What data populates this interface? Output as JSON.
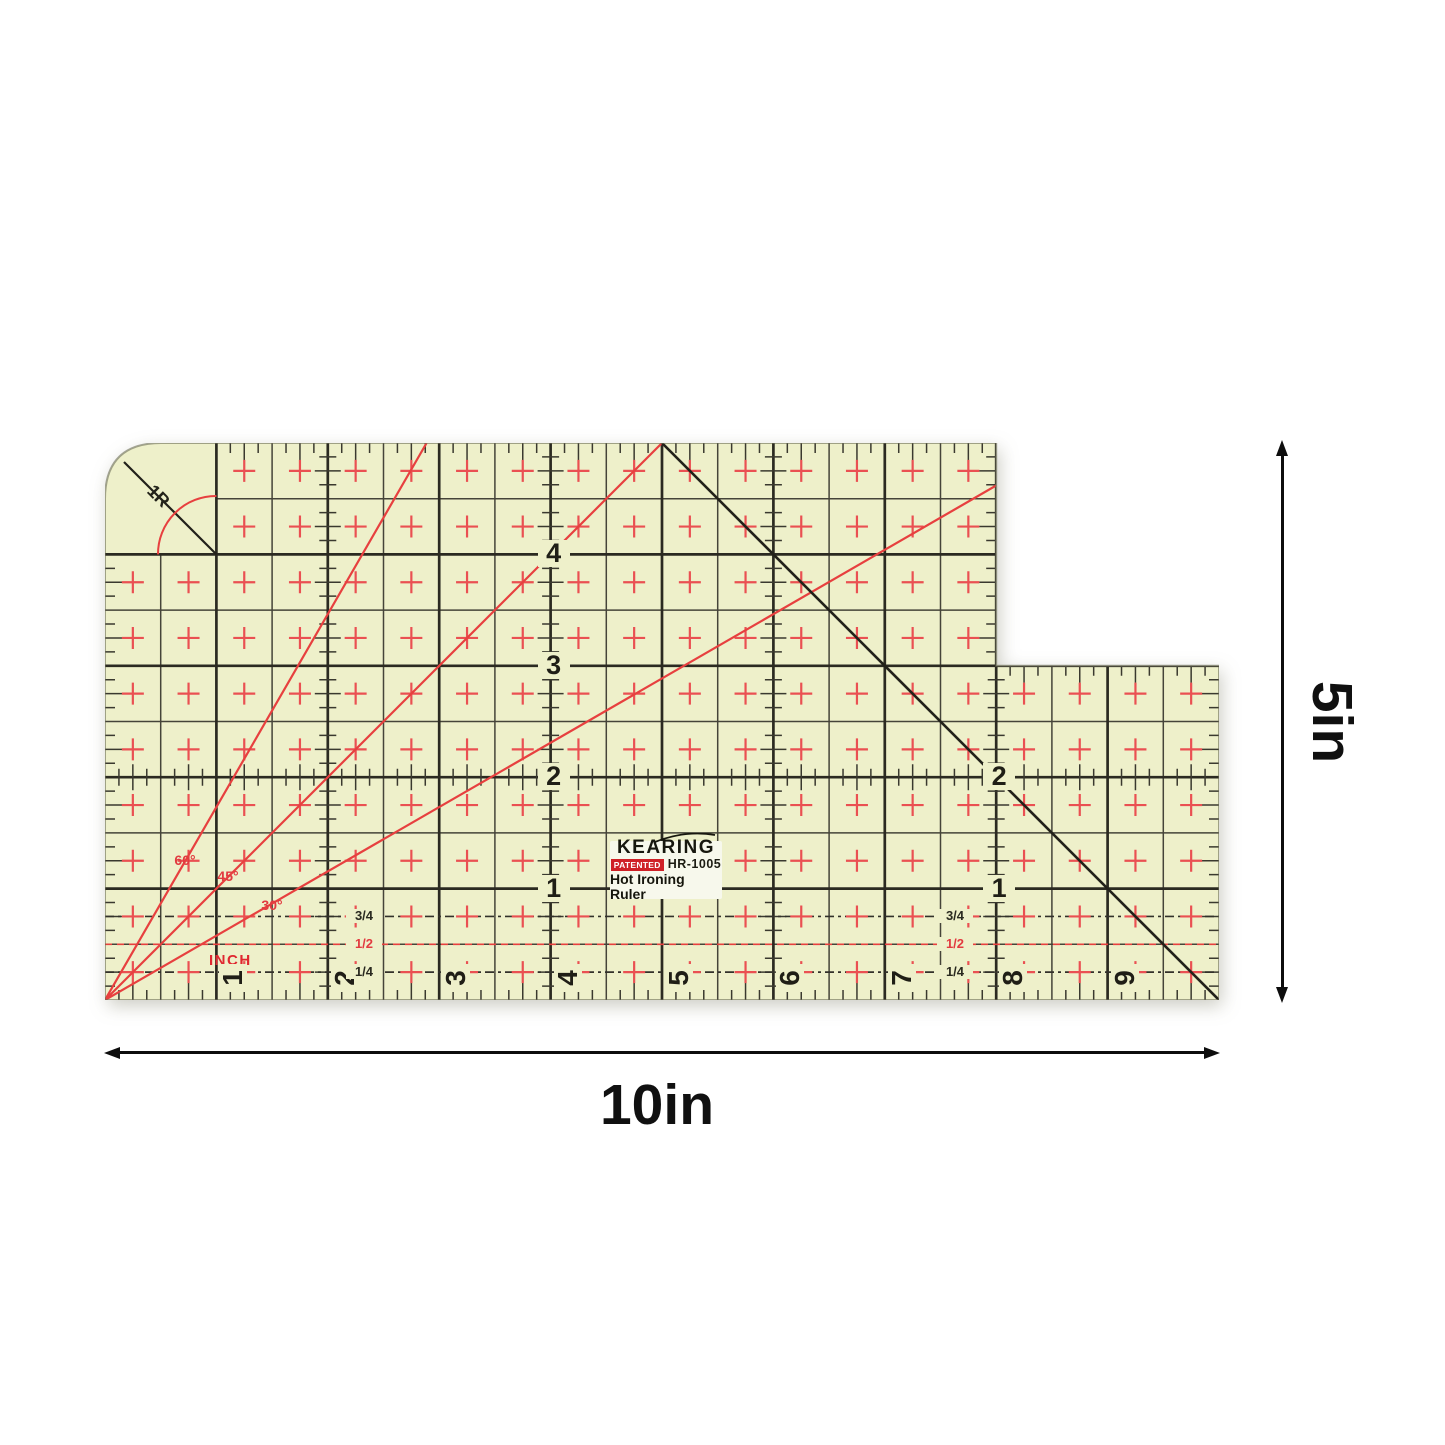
{
  "ruler": {
    "brand": "KEARING",
    "patent_badge": "PATENTED",
    "model": "HR-1005",
    "product_name": "Hot Ironing Ruler",
    "unit_label": "INCH",
    "corner_radius_label": "1R",
    "width_inches": 10,
    "height_inches": 5,
    "notch_at_inch": 8,
    "notch_depth_inches": 2,
    "left_scale_numbers": [
      "4",
      "3",
      "2",
      "1"
    ],
    "right_scale_numbers": [
      "2",
      "1"
    ],
    "bottom_scale_numbers": [
      "1",
      "2",
      "3",
      "4",
      "5",
      "6",
      "7",
      "8",
      "9"
    ],
    "fraction_labels": [
      "3/4",
      "1/2",
      "1/4"
    ],
    "angle_labels": [
      "60°",
      "45°",
      "30°"
    ],
    "colors": {
      "body": "#eef0ca",
      "grid_inch": "#2b2a21",
      "grid_half": "#454439",
      "tick": "#3a392f",
      "red_line": "#e7403f",
      "red_plus": "#ea5052",
      "black_diag": "#22211a",
      "dash_black": "#32312a",
      "label_bg": "#f7f8ec",
      "patent_red": "#cf2127",
      "outline": "#6a6d55",
      "annotation": "#0d0d0d"
    }
  },
  "annotations": {
    "width_label": "10in",
    "height_label": "5in"
  }
}
